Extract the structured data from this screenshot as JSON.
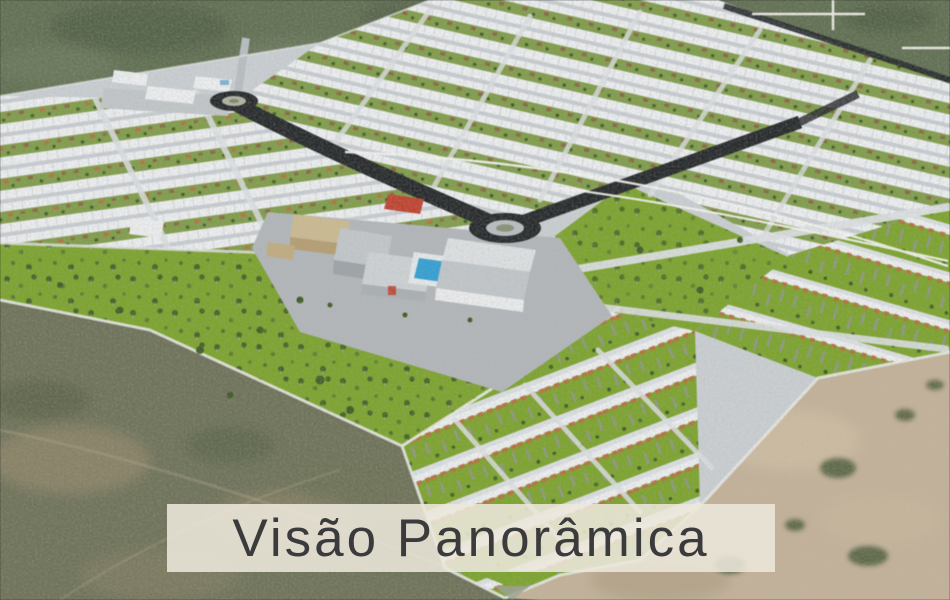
{
  "caption": {
    "text": "Visão Panorâmica"
  },
  "scene": {
    "type": "3d-aerial-render",
    "subject": "Panoramic master-plan view of a residential land development surrounded by scrubland",
    "elements": [
      "residential house blocks",
      "central clubhouse and facilities",
      "swimming pool",
      "main asphalt avenue",
      "entrance roundabout",
      "central roundabout",
      "green parks with scattered trees",
      "tree-lined lot rows",
      "surrounding scrubland and sand terrain",
      "white route overlay lines",
      "crosshair overlay"
    ]
  },
  "colors": {
    "grass": "#5f6e51",
    "scrub": "#6d7158",
    "sand": "#c5b29a",
    "dev-base": "#cbd0d5",
    "street": "#c9ced4",
    "street-light": "#dde1e5",
    "park-green": "#7ba32b",
    "yard-green": "#7f9c49",
    "tree-dark": "#3c5a22",
    "poplar-gray": "#8e968a",
    "roof-white": "#eef0f3",
    "roof-brown": "#8a6442",
    "roof-orange": "#b5703e",
    "roof-red": "#c0402e",
    "road-dark": "#232629",
    "plaza-gray": "#b3b7bc",
    "building-beige": "#cdbb92",
    "pool-blue": "#2f9fd6",
    "overlay-white": "#f7f7f4",
    "caption-bg": "rgba(236,231,219,0.88)",
    "caption-text": "#3b3b3d"
  }
}
